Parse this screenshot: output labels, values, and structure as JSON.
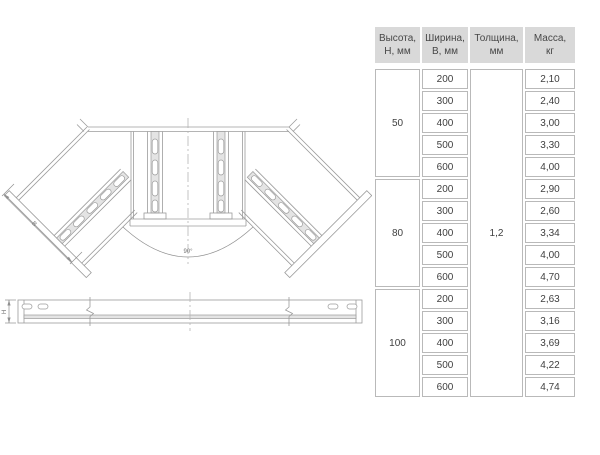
{
  "page": {
    "background": "#ffffff"
  },
  "table": {
    "header": [
      {
        "line1": "Высота,",
        "line2": "Н, мм"
      },
      {
        "line1": "Ширина,",
        "line2": "В, мм"
      },
      {
        "line1": "Толщина,",
        "line2": "мм"
      },
      {
        "line1": "Масса,",
        "line2": "кг"
      }
    ],
    "thickness": "1,2",
    "groups": [
      {
        "height": "50",
        "rows": [
          {
            "w": "200",
            "m": "2,10"
          },
          {
            "w": "300",
            "m": "2,40"
          },
          {
            "w": "400",
            "m": "3,00"
          },
          {
            "w": "500",
            "m": "3,30"
          },
          {
            "w": "600",
            "m": "4,00"
          }
        ]
      },
      {
        "height": "80",
        "rows": [
          {
            "w": "200",
            "m": "2,90"
          },
          {
            "w": "300",
            "m": "2,60"
          },
          {
            "w": "400",
            "m": "3,34"
          },
          {
            "w": "500",
            "m": "4,00"
          },
          {
            "w": "600",
            "m": "4,70"
          }
        ]
      },
      {
        "height": "100",
        "rows": [
          {
            "w": "200",
            "m": "2,63"
          },
          {
            "w": "300",
            "m": "3,16"
          },
          {
            "w": "400",
            "m": "3,69"
          },
          {
            "w": "500",
            "m": "4,22"
          },
          {
            "w": "600",
            "m": "4,74"
          }
        ]
      }
    ],
    "colors": {
      "header_bg": "#d9d9d9",
      "border": "#b9b9b9",
      "text": "#3f3f3f"
    }
  },
  "drawing": {
    "angle_label": "90°",
    "width_label": "В",
    "height_label": "Н"
  }
}
